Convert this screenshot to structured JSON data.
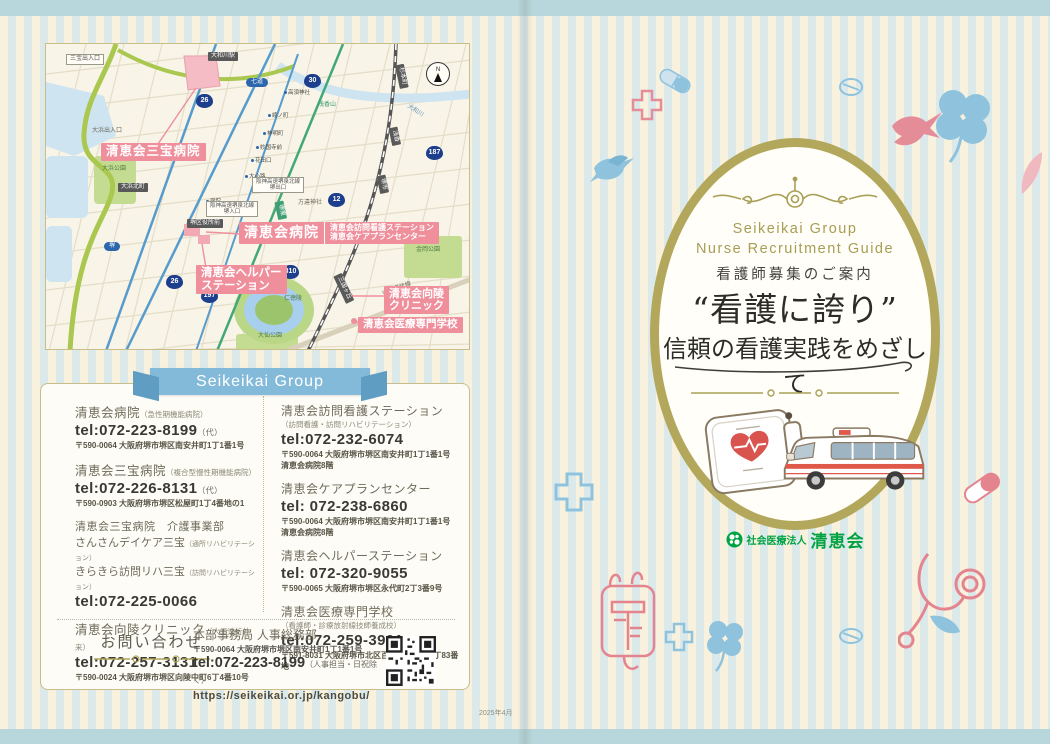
{
  "colors": {
    "stripe_blue": "#dbe9eb",
    "stripe_cream": "#f7f1de",
    "band_blue": "#b7d7dc",
    "olive": "#b3a75c",
    "pink_label": "#ef8f9c",
    "ribbon_blue": "#83bada",
    "logo_green": "#00a244"
  },
  "map": {
    "facilities": {
      "sanbo": "清恵会三宝病院",
      "main": "清恵会病院",
      "main_side1": "清恵会訪問看護ステーション",
      "main_side2": "清恵会ケアプランセンター",
      "helper1": "清恵会ヘルパー",
      "helper2": "ステーション",
      "koryo1": "清恵会向陵",
      "koryo2": "クリニック",
      "school": "清恵会医療専門学校"
    },
    "route_badges": [
      "26",
      "30",
      "187",
      "12",
      "310",
      "26",
      "197"
    ],
    "stations_dark": [
      "大和川駅",
      "大浜北町",
      "堺区役所前",
      "杉本町",
      "浅香",
      "堺市",
      "三国ヶ丘",
      "堺東"
    ],
    "stations_blue": [
      "七道",
      "堺"
    ],
    "tram_stops": [
      "高須神社",
      "綾ノ町",
      "神明町",
      "妙国寺前",
      "花田口",
      "大小路",
      "宿院"
    ],
    "highway_exit": {
      "l1": "阪神高速堺泉北線",
      "l2": "堺出口"
    },
    "highway_ent": {
      "l1": "阪神高速堺泉北線",
      "l2": "堺入口"
    },
    "misc": {
      "sanbo_ic": "三宝出入口",
      "ohama_ic": "大浜出入口",
      "asakayama": "浅香山",
      "hochigai": "方違神社",
      "city_hall": "堺市役所",
      "river": "大和川",
      "chuo_kanjo": "中央環状線",
      "compass_n": "N"
    },
    "parks": {
      "ohama": "大浜公園",
      "kanaoka": "金岡公園",
      "nintoku": "仁徳陵",
      "daisen": "大仙公園"
    }
  },
  "ribbon": "Seikeikai Group",
  "contacts": {
    "left": [
      {
        "name": "清恵会病院",
        "note": "（急性期機能病院）",
        "tel": "tel:072-223-8199",
        "tel_note": "（代）",
        "addr": "〒590-0064 大阪府堺市堺区南安井町1丁1番1号"
      },
      {
        "name": "清恵会三宝病院",
        "note": "（複合型慢性期機能病院）",
        "tel": "tel:072-226-8131",
        "tel_note": "（代）",
        "addr": "〒590-0903 大阪府堺市堺区松屋町1丁4番地の1"
      },
      {
        "name": "清恵会三宝病院　介護事業部",
        "line1": "さんさんデイケア三宝",
        "line1_note": "（通所リハビリテーション）",
        "line2": "きらきら訪問リハ三宝",
        "line2_note": "（訪問リハビリテーション）",
        "tel": "tel:072-225-0066"
      },
      {
        "name": "清恵会向陵クリニック",
        "note": "（人工透析外来）",
        "tel": "tel:072-257-3131",
        "addr": "〒590-0024 大阪府堺市堺区向陵中町6丁4番10号"
      }
    ],
    "right": [
      {
        "name": "清恵会訪問看護ステーション",
        "note": "（訪問看護・訪問リハビリテーション）",
        "tel": "tel:072-232-6074",
        "addr": "〒590-0064 大阪府堺市堺区南安井町1丁1番1号",
        "addr2": "清恵会病院8階"
      },
      {
        "name": "清恵会ケアプランセンター",
        "tel": "tel: 072-238-6860",
        "addr": "〒590-0064 大阪府堺市堺区南安井町1丁1番1号",
        "addr2": "清恵会病院8階"
      },
      {
        "name": "清恵会ヘルパーステーション",
        "tel": "tel: 072-320-9055",
        "addr": "〒590-0065 大阪府堺市堺区永代町2丁3番9号"
      },
      {
        "name": "清恵会医療専門学校",
        "note": "（看護師・診療放射線技師養成校）",
        "tel": "tel:072-259-3901",
        "addr": "〒591-8031 大阪府堺市北区百舌鳥梅北町2丁83番地"
      }
    ],
    "inquiry": {
      "label": "お問い合わせ",
      "dept": "本部事務局 人事総務部",
      "addr": "〒590-0064 大阪府堺市堺区南安井町1丁1番1号",
      "tel": "tel:072-223-8199",
      "tel_note": "（人事担当・日祝除く）",
      "url": "https://seikeikai.or.jp/kangobu/"
    }
  },
  "cover": {
    "en_line1": "Seikeikai Group",
    "en_line2": "Nurse Recruitment Guide",
    "subtitle": "看護師募集のご案内",
    "title": "“看護に誇り”",
    "tagline": "信頼の看護実践をめざして",
    "org_type": "社会医療法人",
    "org_name": "清恵会"
  },
  "footer": {
    "date": "2025年4月"
  }
}
